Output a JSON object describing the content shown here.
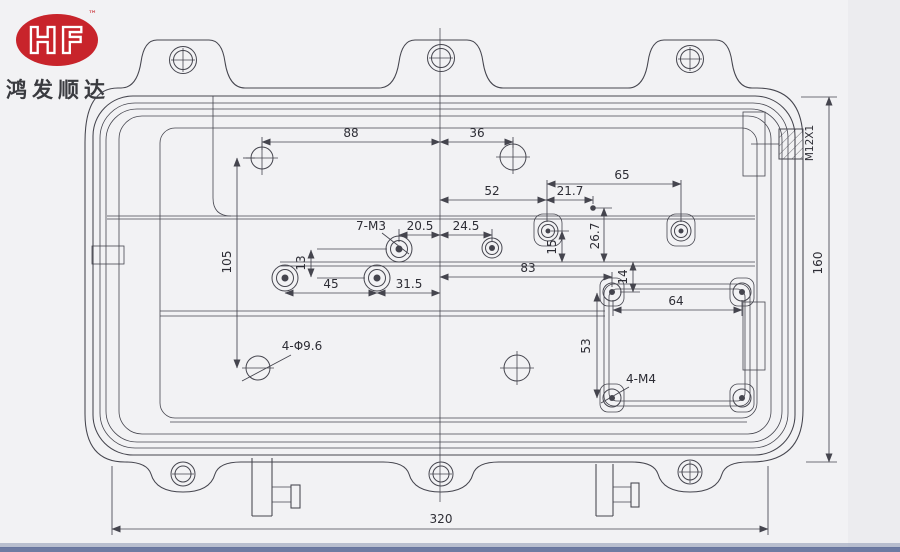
{
  "colors": {
    "brand_red": "#c8242b",
    "line": "#45454e",
    "ink": "#2d2d35",
    "paper": "#f2f2f4",
    "paper_edge": "#e9e9ec",
    "bottom_strip": "#5f6e99"
  },
  "logo": {
    "text": "HF",
    "tm": "™",
    "company": "鸿发顺达"
  },
  "dimensions": {
    "d88": "88",
    "d36": "36",
    "d52": "52",
    "d21_7": "21.7",
    "d65": "65",
    "d20_5": "20.5",
    "d24_5": "24.5",
    "d15": "15",
    "d26_7": "26.7",
    "d83": "83",
    "d14": "14",
    "d45": "45",
    "d31_5": "31.5",
    "d64": "64",
    "d53": "53",
    "d13": "13",
    "d105": "105",
    "d320": "320",
    "d160": "160"
  },
  "labels": {
    "thread_7m3": "7-M3",
    "thread_4m4": "4-M4",
    "holes_phi": "4-Φ9.6",
    "thread_m12": "M12X1"
  }
}
